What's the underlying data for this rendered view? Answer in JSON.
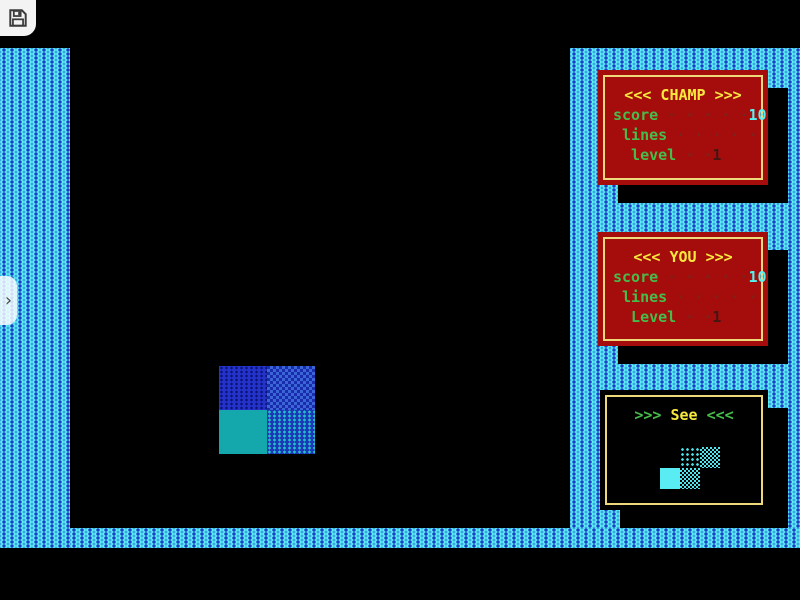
{
  "overlay": {
    "save_button": {
      "icon": "floppy-disk-icon"
    },
    "drawer_handle": {
      "glyph": "›",
      "icon": "chevron-right-icon"
    }
  },
  "panels": {
    "champ": {
      "title": "<<< CHAMP >>>",
      "rows": [
        {
          "label": "score",
          "dots": " · · · · ·",
          "value": "10"
        },
        {
          "label": " lines",
          "dots": " · · · · ·",
          "value": ""
        },
        {
          "label": "  level",
          "dots": " · ·",
          "value": "1"
        }
      ]
    },
    "you": {
      "title": "<<< YOU >>>",
      "rows": [
        {
          "label": "score",
          "dots": " · · · · ·",
          "value": "10"
        },
        {
          "label": " lines",
          "dots": " · · · · ·",
          "value": ""
        },
        {
          "label": "  Level",
          "dots": " · ·",
          "value": "1"
        }
      ]
    },
    "see": {
      "prefix": ">>> ",
      "title": "See",
      "suffix": " <<<"
    }
  },
  "game": {
    "falling_piece": {
      "type": "O-piece",
      "cells": [
        "blue-dotted",
        "blue-checker",
        "teal-solid",
        "cyan-dotted"
      ]
    },
    "next_piece": {
      "type": "S-piece",
      "cells": [
        "dotted",
        "checker",
        "solid",
        "checker"
      ]
    }
  },
  "colors": {
    "panel-red": "#a50d0d",
    "border-yellow": "#eed87c",
    "title-yellow": "#f8e93e",
    "text-green": "#46bd4a",
    "value-cyan": "#55f2f2",
    "dots-red": "#7c241a",
    "level-dim": "#441511",
    "wall-cyan": "#5ff0f6",
    "wall-blue": "#1c3ec6",
    "piece-blue": "#2433cc",
    "piece-teal": "#14a7ab"
  }
}
